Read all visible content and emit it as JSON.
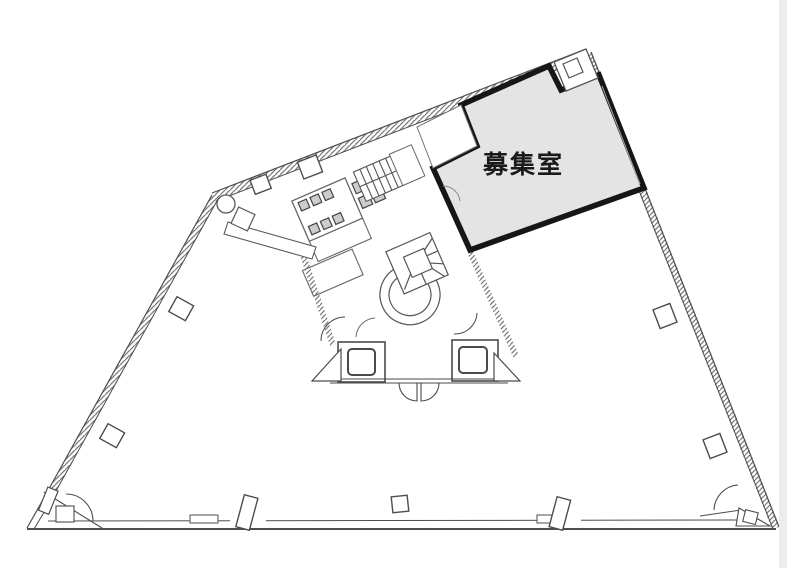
{
  "floor_plan": {
    "room": {
      "label": "募集室",
      "fill": "#e4e4e4",
      "outline": "#161616"
    },
    "colors": {
      "wall_line": "#4d4d4d",
      "thin_line": "#6b6b6b",
      "hatch": "#7a7a7a",
      "fixture_fill": "#cccccc",
      "background": "#ffffff",
      "scan_edge": "#ececec"
    }
  }
}
